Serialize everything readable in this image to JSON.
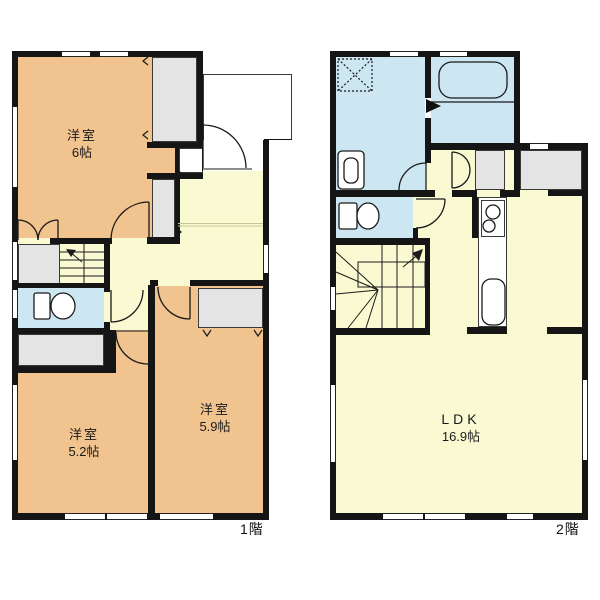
{
  "title": "間取り図",
  "floor_plans": [
    {
      "floor_label": "1階",
      "rooms": [
        {
          "name": "洋室",
          "size": "6帖"
        },
        {
          "name": "洋室",
          "size": "5.2帖"
        },
        {
          "name": "洋室",
          "size": "5.9帖"
        }
      ]
    },
    {
      "floor_label": "2階",
      "rooms": [
        {
          "name": "LDK",
          "size": "16.9帖"
        }
      ]
    }
  ],
  "fixtures": [
    "toilet-icon",
    "bathtub-icon",
    "washbasin-icon",
    "washing-machine-pan-icon",
    "stove-icon",
    "sink-icon",
    "staircase",
    "door-swing",
    "closet",
    "window"
  ],
  "colors": {
    "wall": "#151515",
    "room_orange": "#F1C38E",
    "hall_yellow": "#FAFAD2",
    "wet_area_blue": "#CDE7F2",
    "closet_gray": "#E4E4E4"
  }
}
